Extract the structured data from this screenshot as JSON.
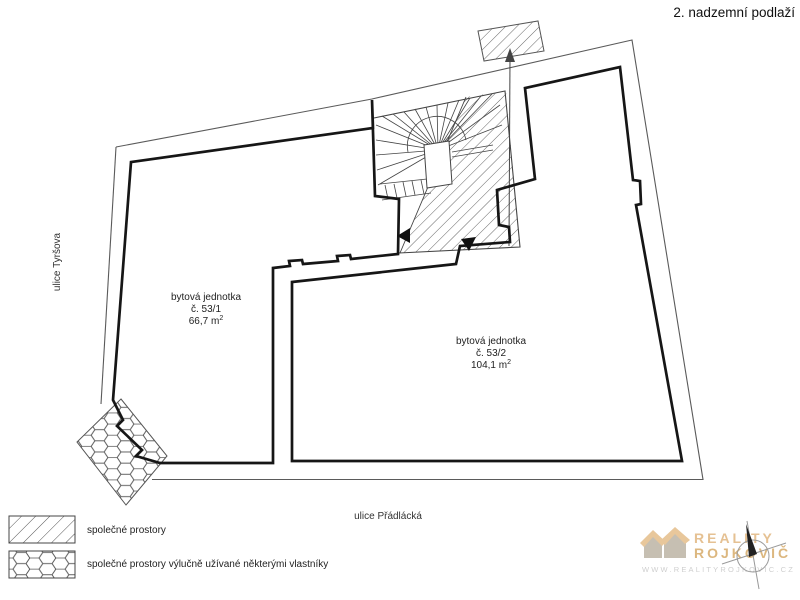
{
  "title": "2. nadzemní podlaží",
  "streets": {
    "left": "ulice Tyršova",
    "bottom": "ulice Přádlácká"
  },
  "units": [
    {
      "name": "bytová jednotka",
      "number": "č. 53/1",
      "area": "66,7 m",
      "area_sup": "2"
    },
    {
      "name": "bytová jednotka",
      "number": "č. 53/2",
      "area": "104,1 m",
      "area_sup": "2"
    }
  ],
  "legend": [
    {
      "swatch": "diagonal-hatch",
      "label": "společné prostory"
    },
    {
      "swatch": "hexagon-mesh",
      "label": "společné prostory výlučně užívané některými vlastníky"
    }
  ],
  "logo": {
    "brand_line1": "REALITY",
    "brand_line2": "ROJKOVIČ",
    "website": "WWW.REALITYROJKOVIC.CZ"
  },
  "colors": {
    "wall": "#161616",
    "thin_line": "#5a5a5a",
    "hatch_line": "#555555",
    "logo_tan": "#e5c193",
    "logo_gray": "#cfcfcf",
    "logo_house_gray": "#c6bfb2"
  }
}
